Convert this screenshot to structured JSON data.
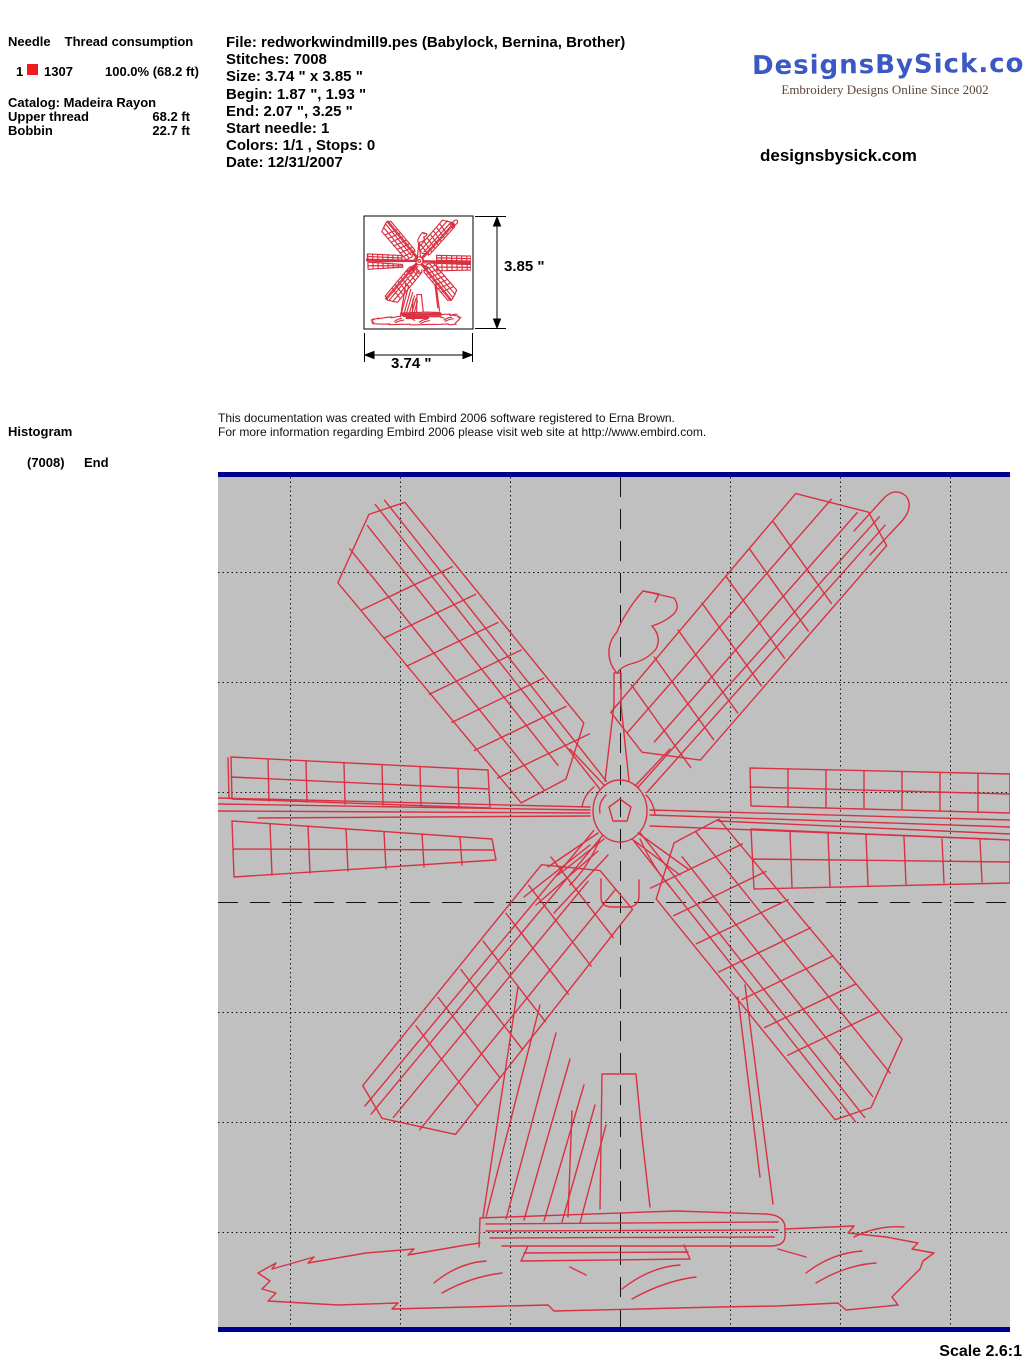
{
  "thread_section": {
    "needle_header": "Needle",
    "consumption_header": "Thread consumption",
    "row": {
      "needle": "1",
      "color_code": "1307",
      "usage": "100.0% (68.2 ft)"
    },
    "catalog": "Catalog: Madeira Rayon",
    "upper_thread_label": "Upper thread",
    "upper_thread_value": "68.2 ft",
    "bobbin_label": "Bobbin",
    "bobbin_value": "22.7 ft"
  },
  "file_info": {
    "file": "File: redworkwindmill9.pes  (Babylock, Bernina, Brother)",
    "stitches": "Stitches: 7008",
    "size": "Size: 3.74 \" x 3.85 \"",
    "begin": "Begin: 1.87 \", 1.93 \"",
    "end": "End: 2.07 \", 3.25 \"",
    "start_needle": "Start needle: 1",
    "colors": "Colors: 1/1 , Stops: 0",
    "date": "Date: 12/31/2007"
  },
  "branding": {
    "logo": "DesignsBySick.com",
    "tagline": "Embroidery Designs Online Since 2002",
    "website": "designsbysick.com"
  },
  "preview": {
    "width_label": "3.74 \"",
    "height_label": "3.85 \""
  },
  "histogram": {
    "title": "Histogram",
    "count": "(7008)",
    "label": "End"
  },
  "note": {
    "line1": "This documentation was created with Embird 2006 software registered to Erna Brown.",
    "line2": "For more information regarding Embird 2006 please visit web site at http://www.embird.com."
  },
  "footer": {
    "scale": "Scale 2.6:1"
  },
  "colors": {
    "stitch_red": "#da3142",
    "swatch_red": "#ee1c1c",
    "navy": "#000090",
    "canvas_gray": "#c0c0c0",
    "grid_black": "#141414",
    "logo_blue": "#3b59c4",
    "tagline_brown": "#5e4536"
  }
}
